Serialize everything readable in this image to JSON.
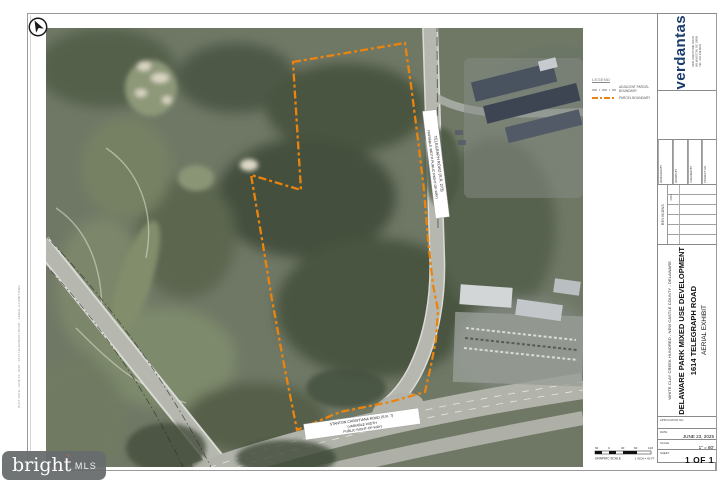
{
  "titleblock": {
    "firm": {
      "name": "verdantas",
      "logo_mark": "leaf-arrow",
      "brand_color": "#1c3e6d",
      "accent_color": "#35a08e",
      "address": "5400 LIMESTONE ROAD\nWILMINGTON, DE 19808\nTEL: 302.239.6634"
    },
    "fields": [
      {
        "label": "DESIGNED BY",
        "value": ""
      },
      {
        "label": "DRAWN BY",
        "value": ""
      },
      {
        "label": "CHECKED BY",
        "value": ""
      },
      {
        "label": "PROJECT NO.",
        "value": ""
      }
    ],
    "revisions_label": "REVISIONS",
    "revisions_date_label": "DATE",
    "county_line": "WHITE CLAY CREEK HUNDRED - NEW CASTLE COUNTY - DELAWARE",
    "project_title_line1": "DELAWARE PARK MIXED USE DEVELOPMENT",
    "project_title_line2": "1614 TELEGRAPH ROAD",
    "sheet_title": "AERIAL EXHIBIT",
    "application_label": "APPLICATION NO.",
    "date_label": "DATE",
    "date_value": "JUNE 23, 2025",
    "scale_label": "SCALE",
    "scale_value": "1\" = 60'",
    "sheet_label": "SHEET",
    "sheet_value": "1 OF 1"
  },
  "legend": {
    "title": "LEGEND",
    "items": [
      {
        "label": "ADJACENT PARCEL BOUNDARY",
        "line_style": "gray-dash-dot",
        "color": "#9a9a9a"
      },
      {
        "label": "PARCEL BOUNDARY",
        "line_style": "orange-dash",
        "color": "#ea840e"
      }
    ]
  },
  "scalebar": {
    "caption": "GRAPHIC SCALE",
    "note": "1 INCH = 60 FT.",
    "ticks": [
      "60",
      "0",
      "30",
      "60",
      "120"
    ]
  },
  "map": {
    "boundary_color": "#ea840e",
    "labels": {
      "road_vertical": [
        "TELEGRAPH ROAD (S.R. 273)",
        "(VARIABLE WIDTH PUBLIC RIGHT-OF-WAY)"
      ],
      "road_bottom": [
        "STANTON CHRISTIANA ROAD (S.R. 7)",
        "(VARIABLE WIDTH",
        "PUBLIC RIGHT-OF-WAY)"
      ]
    }
  },
  "watermark": {
    "brand": "bright",
    "mark": "*",
    "suffix": "MLS"
  },
  "margin_note": "PLOT DATE: JUNE 23, 2025 - 1614 TELEGRAPH ROAD - AERIAL EXHIBIT.DWG"
}
